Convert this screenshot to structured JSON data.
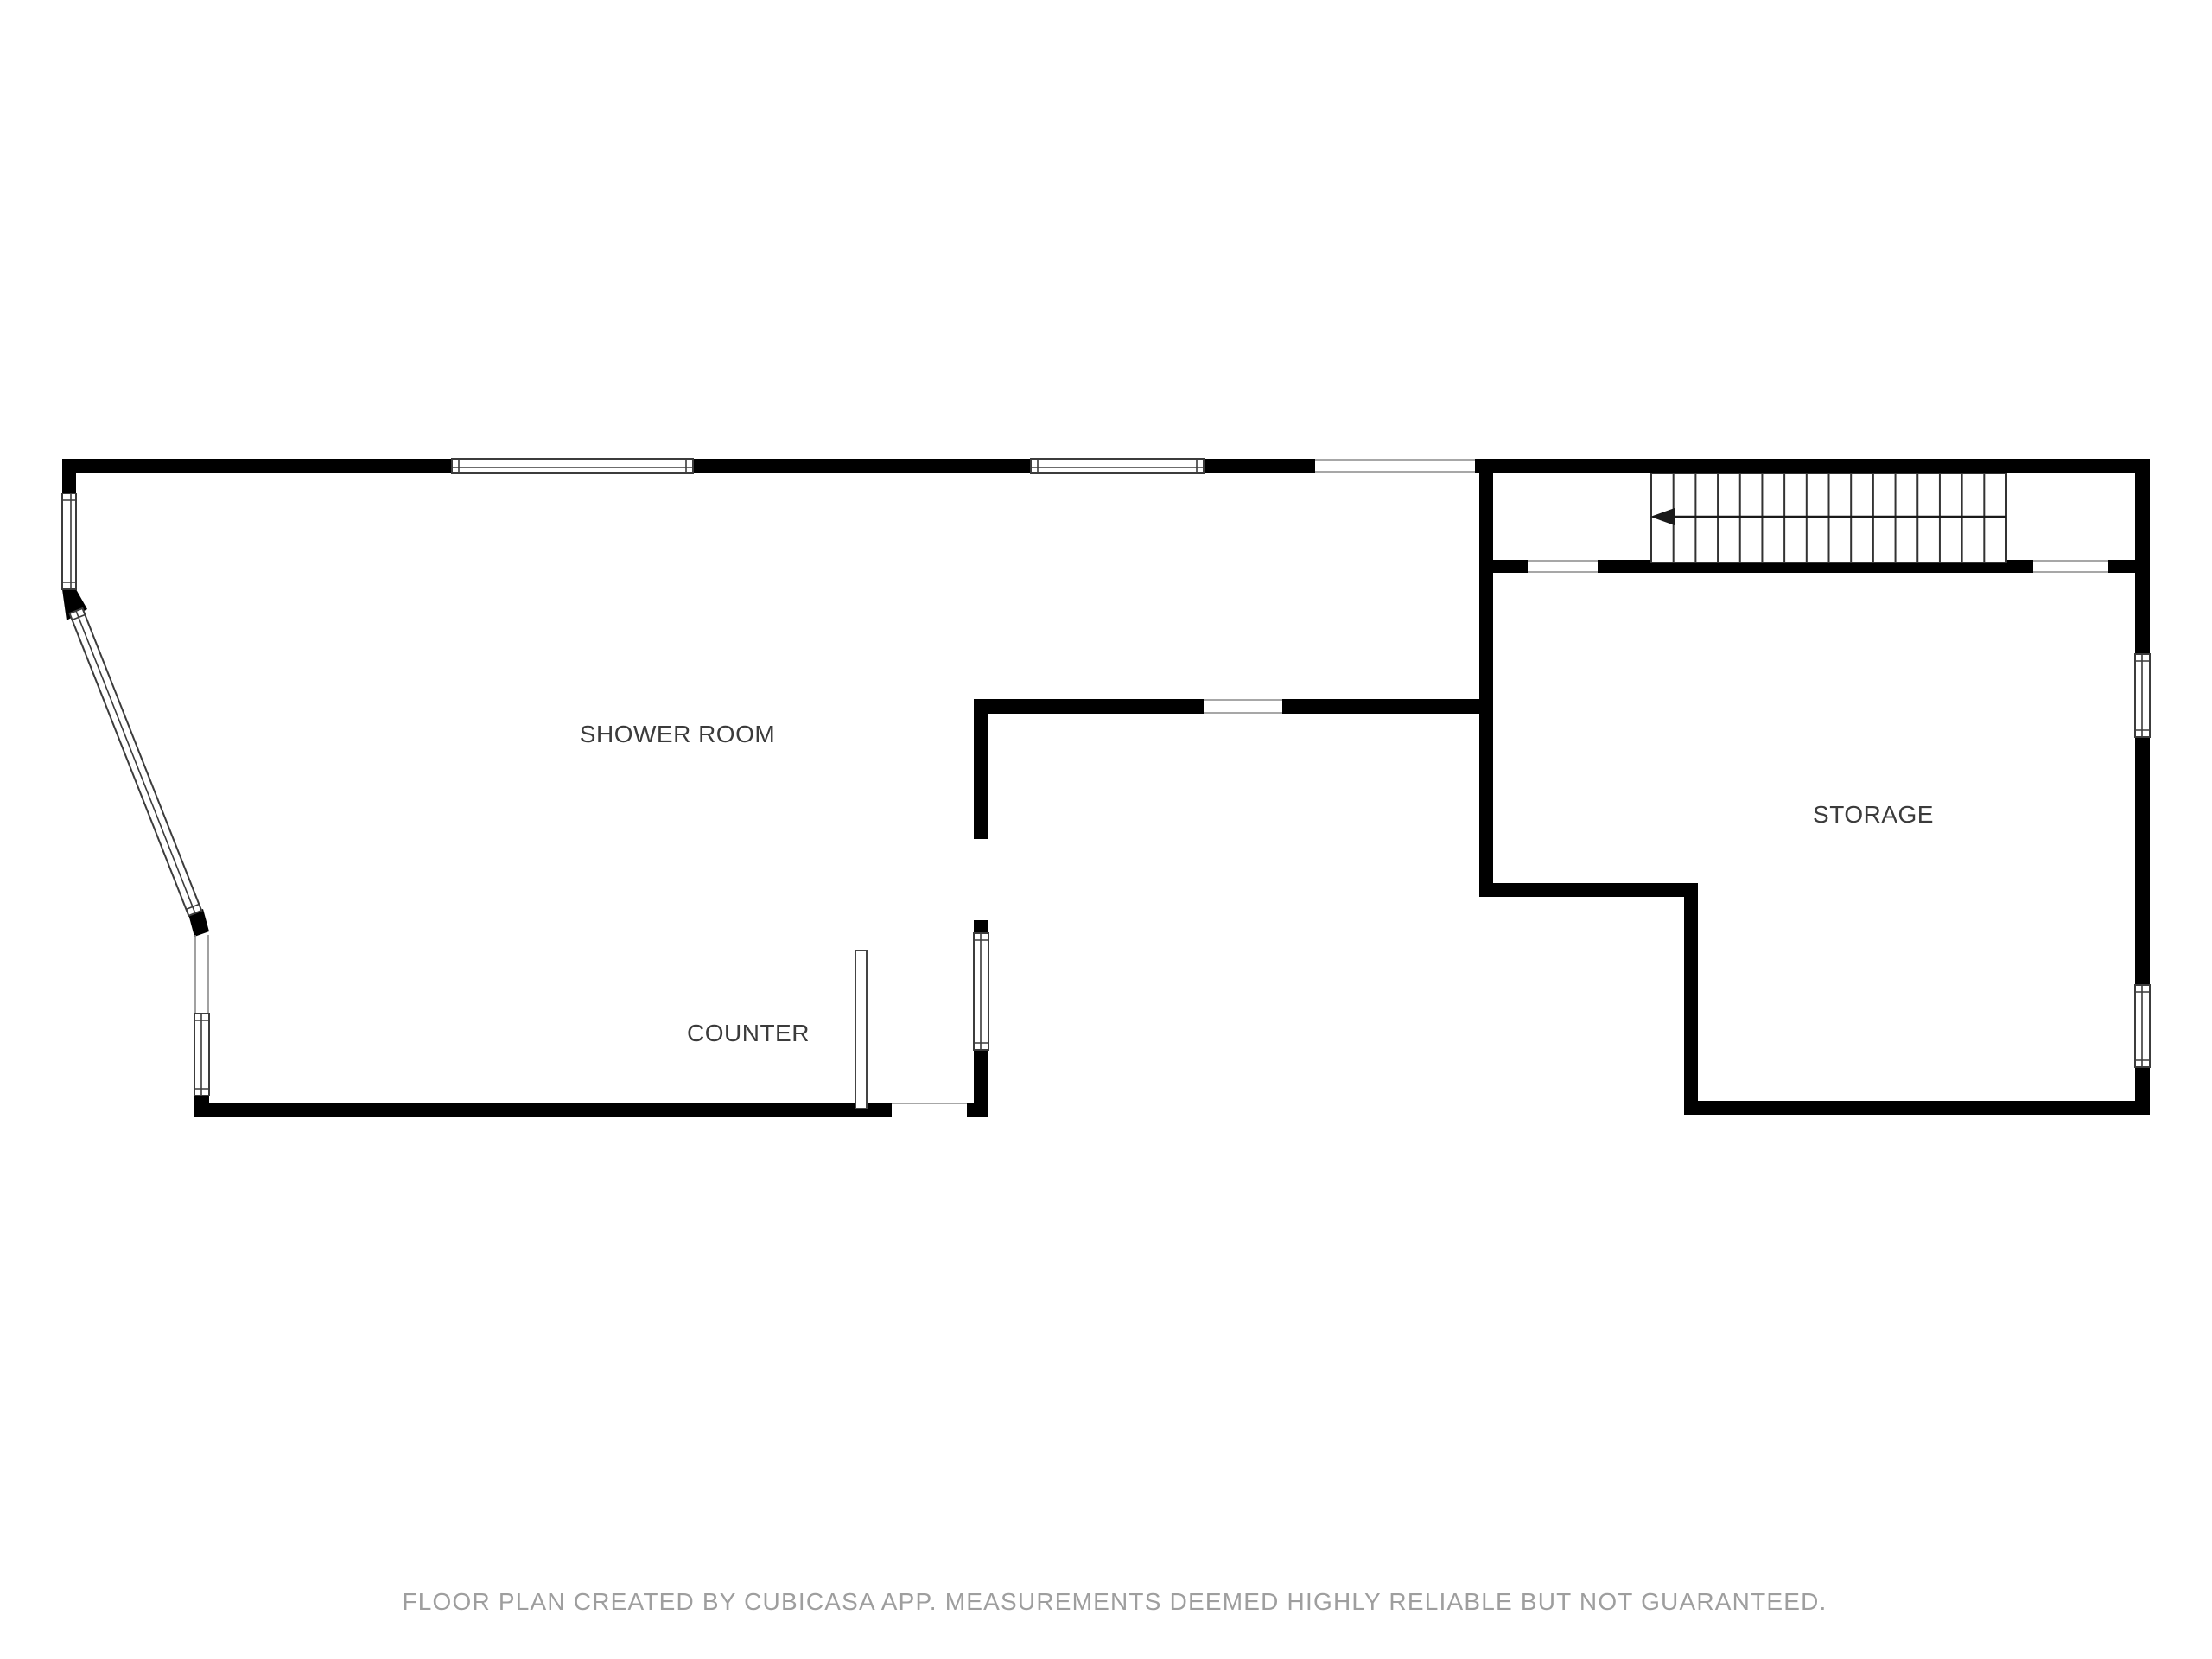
{
  "colors": {
    "background": "#ffffff",
    "wall": "#000000",
    "window_frame": "#3c3c3c",
    "opening_line": "#8a8a8a",
    "label": "#3b3b3b",
    "footer": "#9e9e9e"
  },
  "labels": {
    "shower_room": "SHOWER ROOM",
    "counter": "COUNTER",
    "storage": "STORAGE"
  },
  "stairs": {
    "tread_count": 16,
    "arrow_direction": "left"
  },
  "footer": {
    "text": "FLOOR PLAN CREATED BY CUBICASA APP. MEASUREMENTS DEEMED HIGHLY RELIABLE BUT NOT GUARANTEED."
  }
}
